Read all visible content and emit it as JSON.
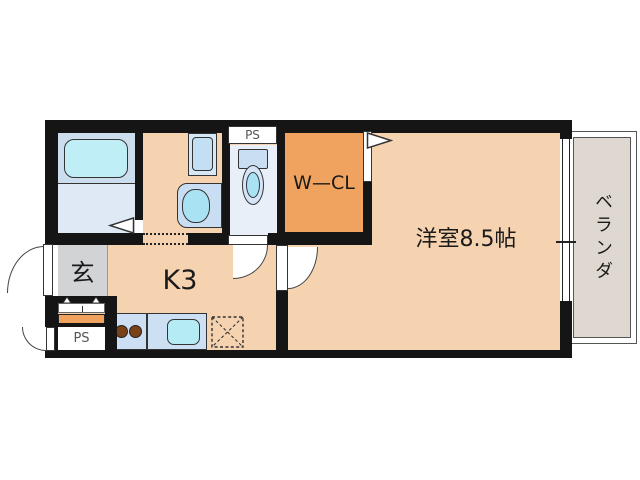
{
  "title": "1K apartment floor plan",
  "rooms": {
    "main": {
      "label": "洋室8.5帖"
    },
    "kitchen": {
      "label": "K3"
    },
    "wcl": {
      "label": "W—CL"
    },
    "genkan": {
      "label": "玄"
    },
    "veranda": {
      "label": "ベランダ"
    },
    "ps_top": {
      "label": "PS"
    },
    "ps_bottom": {
      "label": "PS"
    }
  },
  "fixtures": {
    "bathtub": "unit bath with tub",
    "washing_machine": "washing machine pan",
    "washbasin": "vanity basin",
    "toilet": "toilet with tank",
    "stove": "two-burner stove",
    "sink": "kitchen sink",
    "refrigerator_space": "dashed box with X"
  },
  "colors": {
    "wall": "#151515",
    "floor_main": "#f5d2b0",
    "floor_wcl": "#efa35e",
    "floor_bath": "#dfe9f5",
    "tub_area": "#ccdeee",
    "bathtub": "#bfeef7",
    "floor_toilet": "#e8eff8",
    "floor_genkan": "#d2d3d5",
    "veranda": "#ded8d0",
    "fixture_blue": "#c9def2",
    "fixture_cyan": "#a9e2f2",
    "counter": "#cddff2",
    "burner": "#7a4218"
  }
}
